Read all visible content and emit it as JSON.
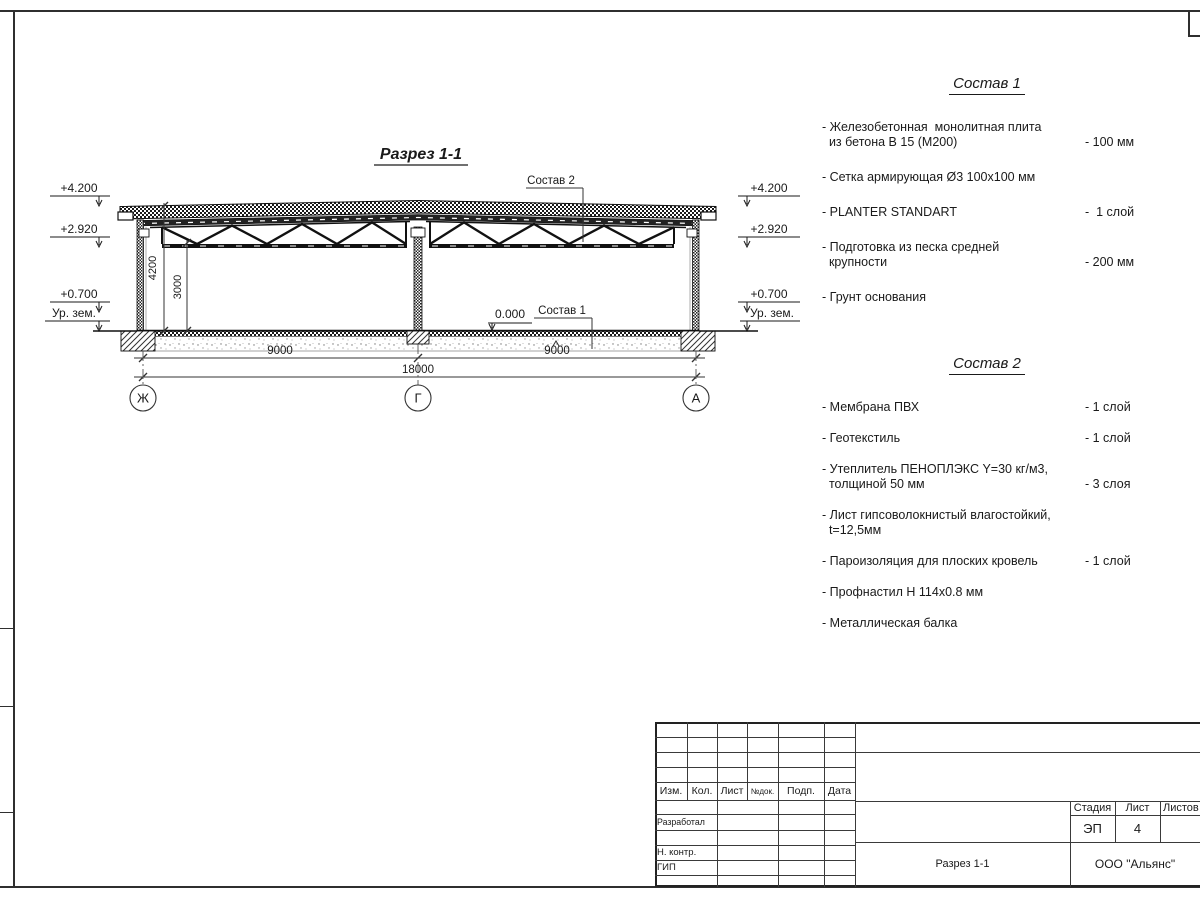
{
  "drawing": {
    "title": "Разрез 1-1",
    "elevation_marks": {
      "top": "+4.200",
      "truss": "+2.920",
      "plinth": "+0.700",
      "ground": "Ур. зем."
    },
    "level_zero": "0.000",
    "ref_sostav1": "Состав 1",
    "ref_sostav2": "Состав 2",
    "dim_height_total": "4200",
    "dim_height_clear": "3000",
    "dim_span_left": "9000",
    "dim_span_right": "9000",
    "dim_total": "18000",
    "axes": {
      "left": "Ж",
      "center": "Г",
      "right": "А"
    }
  },
  "sostav1": {
    "title": "Состав 1",
    "items": [
      {
        "name": "- Железобетонная  монолитная плита\n  из бетона В 15 (М200)",
        "value": "- 100 мм"
      },
      {
        "name": "- Сетка армирующая Ø3 100х100 мм",
        "value": ""
      },
      {
        "name": "- PLANTER STANDART",
        "value": "-  1 слой"
      },
      {
        "name": "- Подготовка из песка средней\n  крупности",
        "value": "- 200 мм"
      },
      {
        "name": "- Грунт основания",
        "value": ""
      }
    ]
  },
  "sostav2": {
    "title": "Состав 2",
    "items": [
      {
        "name": "- Мембрана ПВХ",
        "value": "- 1 слой"
      },
      {
        "name": "- Геотекстиль",
        "value": "- 1 слой"
      },
      {
        "name": "- Утеплитель ПЕНОПЛЭКС Y=30 кг/м3,\n  толщиной 50 мм",
        "value": "- 3 слоя"
      },
      {
        "name": "- Лист гипсоволокнистый влагостойкий,\n  t=12,5мм",
        "value": ""
      },
      {
        "name": "- Пароизоляция для плоских кровель",
        "value": "- 1 слой"
      },
      {
        "name": "- Профнастил Н 114х0.8 мм",
        "value": ""
      },
      {
        "name": "- Металлическая балка",
        "value": ""
      }
    ]
  },
  "titleblock": {
    "rev_headers": [
      "Изм.",
      "Кол.",
      "Лист",
      "№док.",
      "Подп.",
      "Дата"
    ],
    "roles": {
      "developed": "Разработал",
      "ncontrol": "Н. контр.",
      "gip": "ГИП"
    },
    "stamp": {
      "stage_label": "Стадия",
      "sheet_label": "Лист",
      "sheets_label": "Листов",
      "stage_value": "ЭП",
      "sheet_value": "4",
      "sheets_value": ""
    },
    "doc_name": "Разрез 1-1",
    "company": "ООО \"Альянс\""
  },
  "colors": {
    "line": "#2f2f2f",
    "bg": "#ffffff"
  }
}
